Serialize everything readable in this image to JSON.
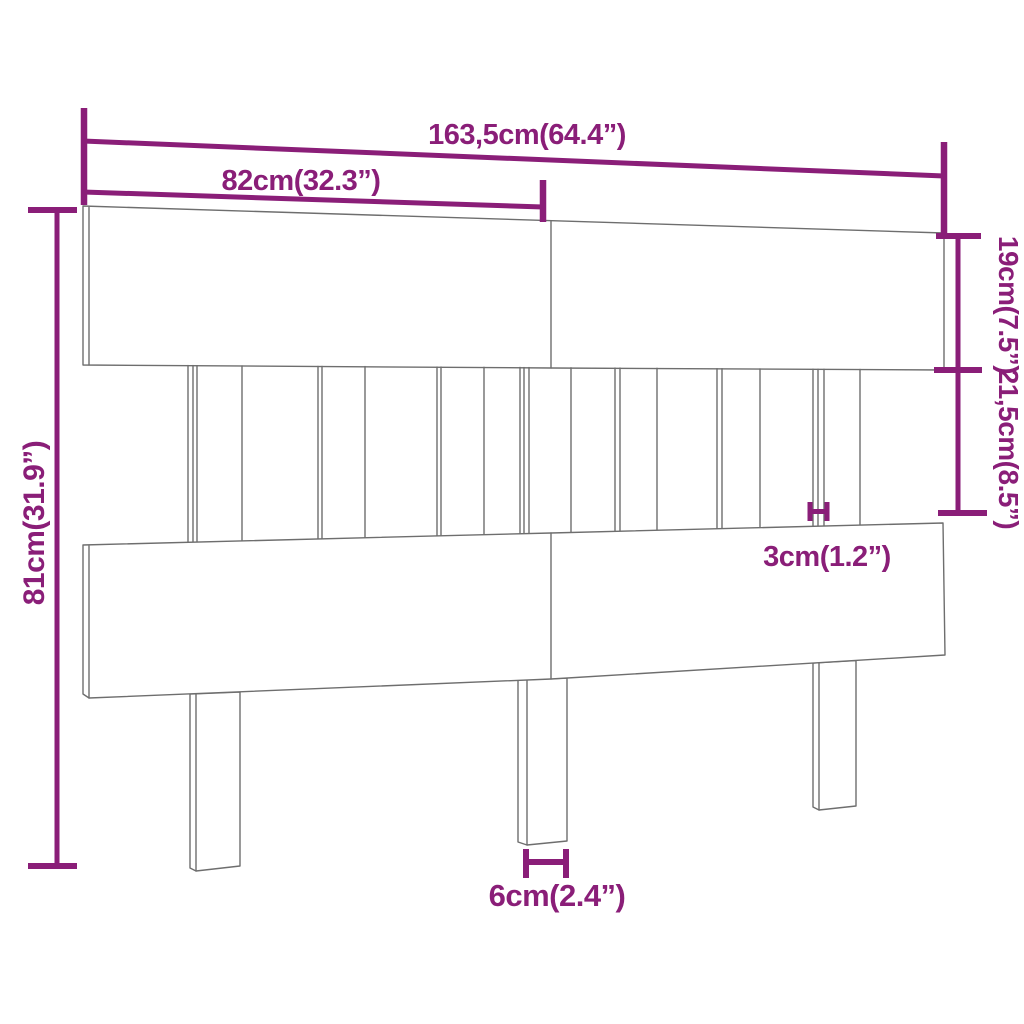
{
  "diagram": {
    "description": "Headboard product dimension diagram, perspective line drawing with purple measurement annotations",
    "colors": {
      "dimension": "#8A1E78",
      "line": "#6E6E6E",
      "background": "#FFFFFF"
    },
    "labels": {
      "overall_width": "163,5cm(64.4”)",
      "left_section_width": "82cm(32.3”)",
      "top_rail_height": "19cm(7.5”)",
      "middle_section_height": "21,5cm(8.5”)",
      "overall_height": "81cm(31.9”)",
      "slat_gap": "3cm(1.2”)",
      "leg_width": "6cm(2.4”)"
    }
  }
}
